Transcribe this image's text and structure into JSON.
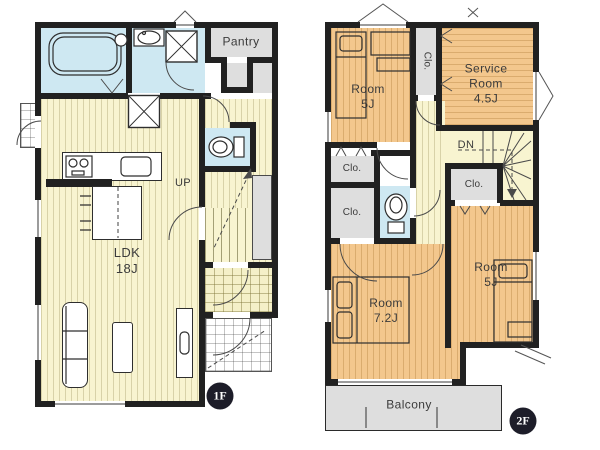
{
  "colors": {
    "wall": "#212121",
    "tan": "#f3c78d",
    "yellow": "#f8f4d0",
    "blue": "#cee8f2",
    "gray": "#dedede",
    "badge_bg": "#1d1d29",
    "badge_text": "#ffffff",
    "text": "#3b3b3b"
  },
  "floor1": {
    "badge": "1F",
    "labels": {
      "pantry": "Pantry",
      "stairs_up": "UP",
      "ldk_name": "LDK",
      "ldk_size": "18J"
    }
  },
  "floor2": {
    "badge": "2F",
    "labels": {
      "room_nw_name": "Room",
      "room_nw_size": "5J",
      "service_line1": "Service",
      "service_line2": "Room",
      "service_size": "4.5J",
      "closet": "Clo.",
      "stairs_dn": "DN",
      "room_sw_name": "Room",
      "room_sw_size": "7.2J",
      "room_se_name": "Room",
      "room_se_size": "5J",
      "balcony": "Balcony"
    }
  }
}
